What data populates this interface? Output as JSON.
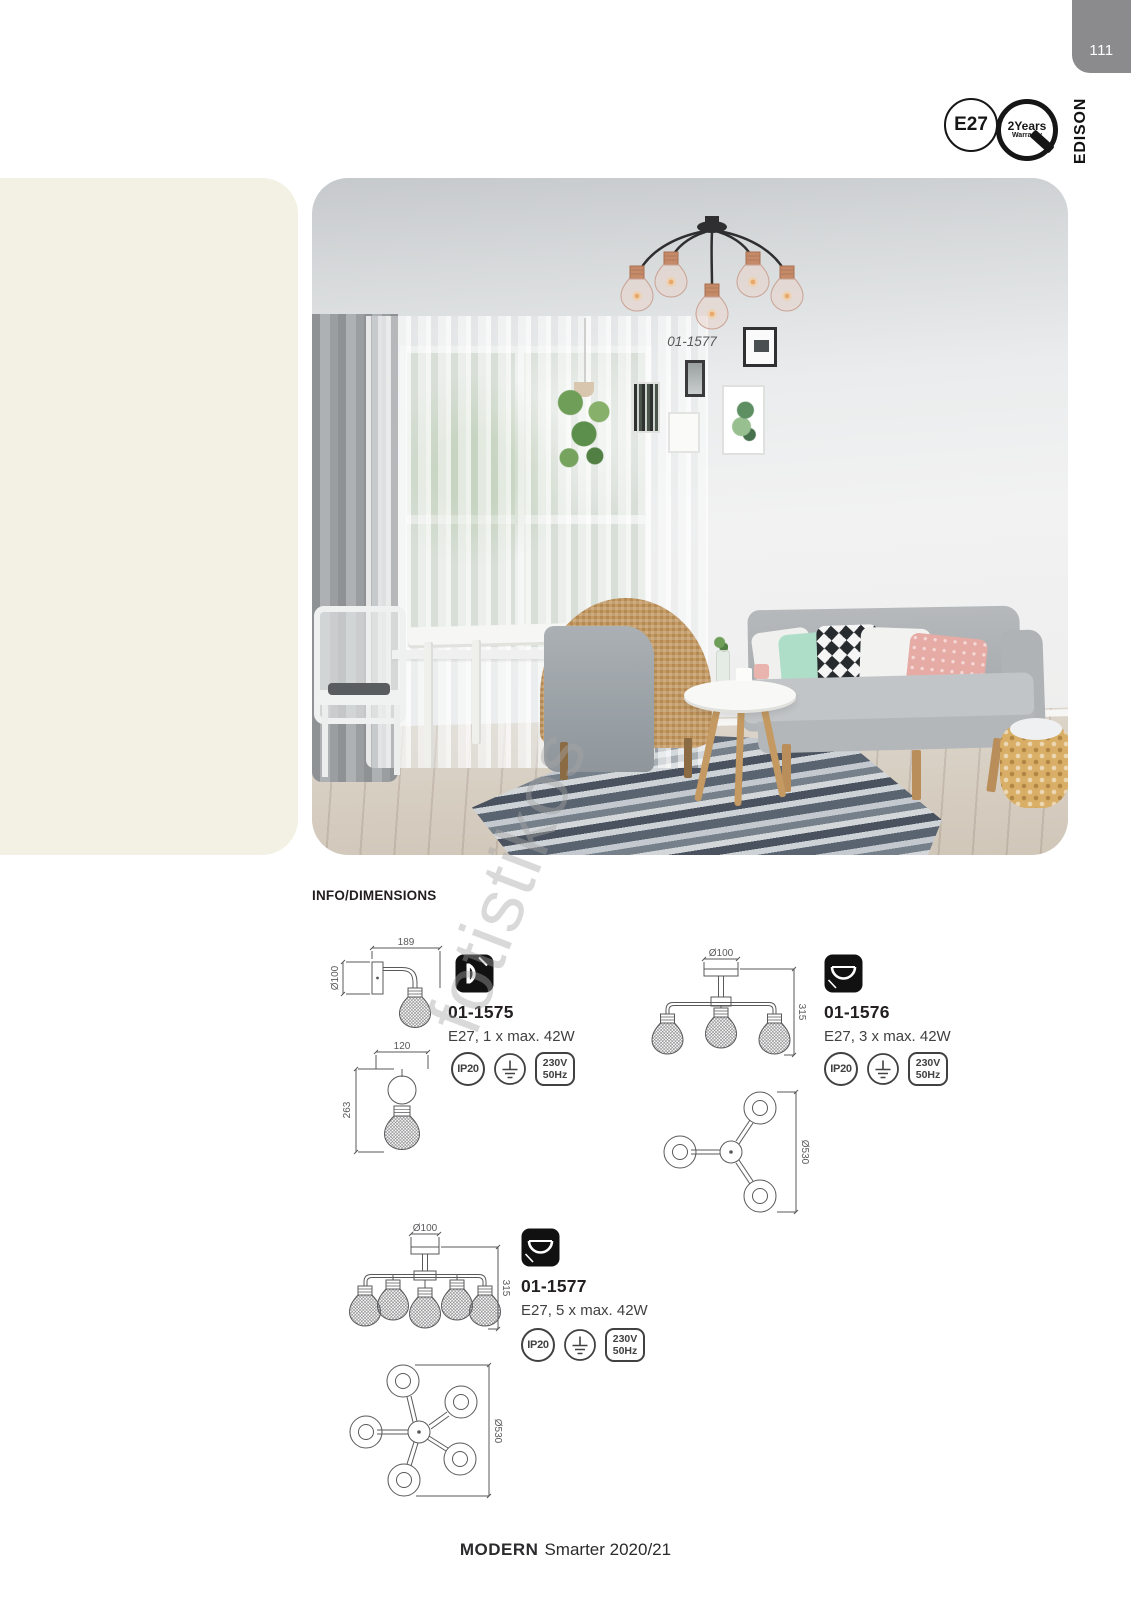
{
  "page": {
    "number": "111",
    "category_tab": "EDISON",
    "info_heading": "INFO/DIMENSIONS",
    "watermark": "fotistikos",
    "footer": {
      "brand": "MODERN",
      "edition": "Smarter 2020/21"
    }
  },
  "badges": {
    "socket": "E27",
    "warranty_line1": "2Years",
    "warranty_line2": "Warranty"
  },
  "hero": {
    "caption": "01-1577"
  },
  "products": [
    {
      "code": "01-1575",
      "spec": "E27, 1 x max. 42W",
      "ip_rating": "IP20",
      "voltage": "230V",
      "frequency": "50Hz",
      "dims": {
        "width": "189",
        "plate_diameter": "Ø100",
        "depth": "120",
        "height": "263"
      }
    },
    {
      "code": "01-1576",
      "spec": "E27, 3 x max. 42W",
      "ip_rating": "IP20",
      "voltage": "230V",
      "frequency": "50Hz",
      "dims": {
        "canopy_diameter": "Ø100",
        "height": "315",
        "spread_diameter": "Ø530"
      }
    },
    {
      "code": "01-1577",
      "spec": "E27, 5 x max. 42W",
      "ip_rating": "IP20",
      "voltage": "230V",
      "frequency": "50Hz",
      "dims": {
        "canopy_diameter": "Ø100",
        "height": "315",
        "spread_diameter": "Ø530"
      }
    }
  ],
  "colors": {
    "cream_panel": "#f2f1e3",
    "tab_gray": "#8b8b8d",
    "copper_accent": "#c58a68",
    "drawing_line": "#58595b"
  }
}
